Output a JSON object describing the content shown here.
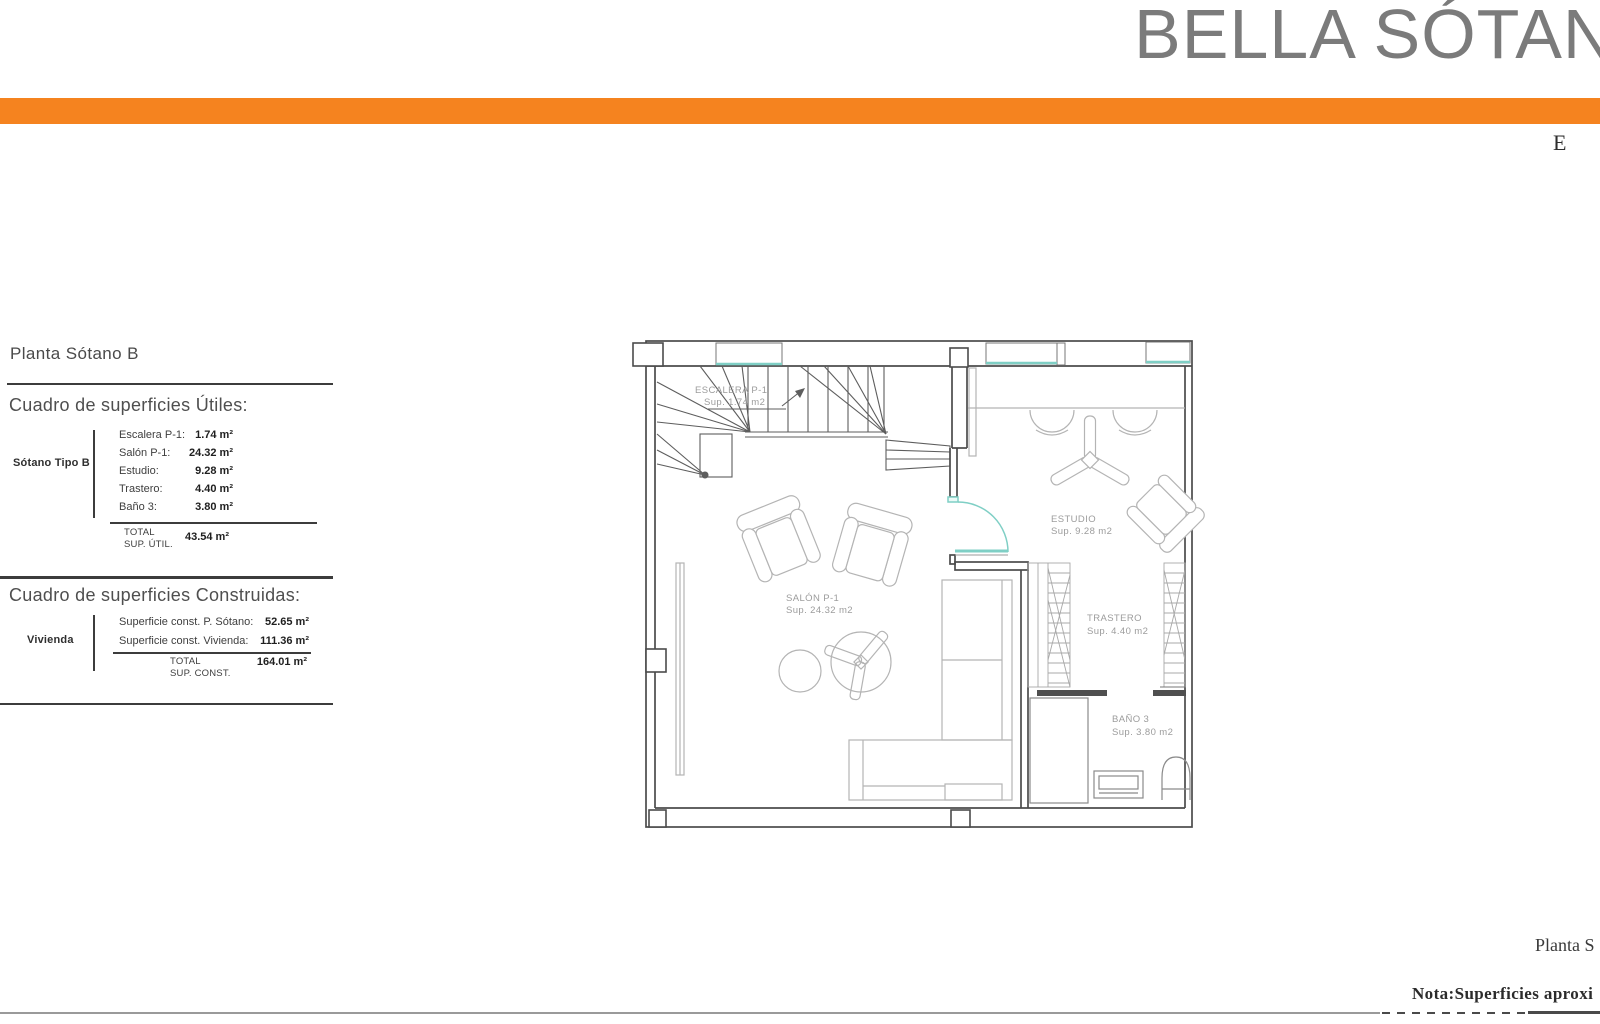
{
  "header": {
    "title": "BELLA SÓTANO",
    "corner_letter": "E",
    "accent_bar_color": "#F5831F"
  },
  "surfaces_panel": {
    "plan_title": "Planta Sótano B",
    "utiles": {
      "heading": "Cuadro de superficies Útiles:",
      "group_label": "Sótano Tipo B",
      "rows": [
        {
          "label": "Escalera P-1:",
          "value": "1.74 m²"
        },
        {
          "label": "Salón P-1:",
          "value": "24.32 m²"
        },
        {
          "label": "Estudio:",
          "value": "9.28 m²"
        },
        {
          "label": "Trastero:",
          "value": "4.40 m²"
        },
        {
          "label": "Baño 3:",
          "value": "3.80 m²"
        }
      ],
      "total_label": "TOTAL",
      "total_sublabel": "SUP. ÚTIL.",
      "total_value": "43.54 m²"
    },
    "construidas": {
      "heading": "Cuadro de superficies Construidas:",
      "group_label": "Vivienda",
      "rows": [
        {
          "label": "Superficie const. P. Sótano:",
          "value": "52.65 m²"
        },
        {
          "label": "Superficie const. Vivienda:",
          "value": "111.36 m²"
        }
      ],
      "total_label": "TOTAL",
      "total_sublabel": "SUP. CONST.",
      "total_value": "164.01 m²"
    }
  },
  "floor_plan": {
    "window_color": "#7FCFC5",
    "rooms": {
      "escalera": {
        "name": "ESCALERA P-1",
        "area": "Sup. 1.74 m2"
      },
      "salon": {
        "name": "SALÓN P-1",
        "area": "Sup. 24.32 m2"
      },
      "estudio": {
        "name": "ESTUDIO",
        "area": "Sup. 9.28 m2"
      },
      "trastero": {
        "name": "TRASTERO",
        "area": "Sup. 4.40 m2"
      },
      "bano": {
        "name": "BAÑO 3",
        "area": "Sup. 3.80 m2"
      }
    }
  },
  "footer": {
    "plan_caption": "Planta S",
    "note": "Nota:Superficies aproxi"
  }
}
